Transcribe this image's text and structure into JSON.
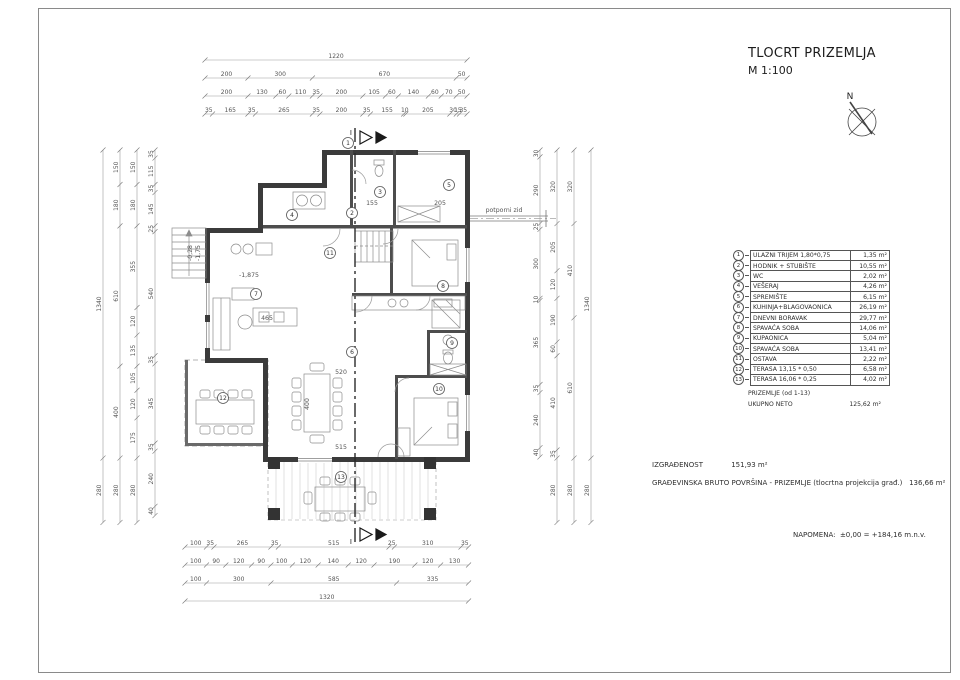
{
  "title_block": {
    "title": "TLOCRT PRIZEMLJA",
    "scale": "M 1:100",
    "north_label": "N"
  },
  "legend": {
    "rows": [
      {
        "num": "1",
        "name": "ULAZNI TRIJEM 1,80*0,75",
        "area": "1,35 m²"
      },
      {
        "num": "2",
        "name": "HODNIK + STUBIŠTE",
        "area": "10,55 m²"
      },
      {
        "num": "3",
        "name": "WC",
        "area": "2,02 m²"
      },
      {
        "num": "4",
        "name": "VEŠERAJ",
        "area": "4,26 m²"
      },
      {
        "num": "5",
        "name": "SPREMIŠTE",
        "area": "6,15 m²"
      },
      {
        "num": "6",
        "name": "KUHINJA+BLAGOVAONICA",
        "area": "26,19 m²"
      },
      {
        "num": "7",
        "name": "DNEVNI BORAVAK",
        "area": "29,77 m²"
      },
      {
        "num": "8",
        "name": "SPAVAĆA SOBA",
        "area": "14,06 m²"
      },
      {
        "num": "9",
        "name": "KUPAONICA",
        "area": "5,04 m²"
      },
      {
        "num": "10",
        "name": "SPAVAĆA SOBA",
        "area": "13,41 m²"
      },
      {
        "num": "11",
        "name": "OSTAVA",
        "area": "2,22 m²"
      },
      {
        "num": "12",
        "name": "TERASA 13,15 * 0,50",
        "area": "6,58 m²"
      },
      {
        "num": "13",
        "name": "TERASA 16,06 * 0,25",
        "area": "4,02 m²"
      }
    ],
    "footer_label": "PRIZEMLJE (od 1-13)",
    "footer_total_label": "UKUPNO NETO",
    "footer_total_area": "125,62 m²"
  },
  "summary": {
    "izgradjenost_label": "IZGRAĐENOST",
    "izgradjenost_value": "151,93 m²",
    "gbp_label": "GRAĐEVINSKA BRUTO POVRŠINA - PRIZEMLJE (tlocrtna projekcija građ.)",
    "gbp_value": "136,66 m²",
    "napomena_label": "NAPOMENA:",
    "napomena_value": "±0,00 = +184,16 m.n.v."
  },
  "plan": {
    "section_label": "I",
    "dim_chains": [
      {
        "dir": "h",
        "x": 205,
        "y": 60,
        "values": [
          1220
        ]
      },
      {
        "dir": "h",
        "x": 205,
        "y": 78,
        "values": [
          200,
          300,
          670,
          50
        ]
      },
      {
        "dir": "h",
        "x": 205,
        "y": 96,
        "values": [
          200,
          130,
          60,
          110,
          35,
          200,
          105,
          60,
          140,
          60,
          70,
          50
        ]
      },
      {
        "dir": "h",
        "x": 205,
        "y": 114,
        "values": [
          35,
          165,
          35,
          265,
          35,
          200,
          35,
          155,
          10,
          205,
          30,
          15,
          35
        ]
      },
      {
        "dir": "h",
        "x": 185,
        "y": 547,
        "values": [
          100,
          35,
          265,
          35,
          515,
          25,
          310,
          35
        ]
      },
      {
        "dir": "h",
        "x": 185,
        "y": 565,
        "values": [
          100,
          90,
          120,
          90,
          100,
          120,
          140,
          120,
          190,
          120,
          130
        ]
      },
      {
        "dir": "h",
        "x": 185,
        "y": 583,
        "values": [
          100,
          300,
          585,
          335
        ]
      },
      {
        "dir": "h",
        "x": 185,
        "y": 601,
        "values": [
          1320
        ]
      },
      {
        "dir": "v",
        "x": 103,
        "y": 150,
        "values": [
          1340,
          280
        ]
      },
      {
        "dir": "v",
        "x": 120,
        "y": 150,
        "values": [
          150,
          180,
          610,
          400,
          280
        ]
      },
      {
        "dir": "v",
        "x": 137,
        "y": 150,
        "values": [
          150,
          180,
          355,
          120,
          135,
          105,
          120,
          175,
          280
        ]
      },
      {
        "dir": "v",
        "x": 155,
        "y": 150,
        "values": [
          35,
          115,
          35,
          145,
          25,
          540,
          35,
          345,
          35,
          240,
          40
        ]
      },
      {
        "dir": "v",
        "x": 540,
        "y": 150,
        "values": [
          30,
          290,
          25,
          300,
          10,
          365,
          35,
          240,
          40
        ]
      },
      {
        "dir": "v",
        "x": 557,
        "y": 150,
        "values": [
          320,
          205,
          120,
          190,
          60,
          410,
          35,
          280
        ]
      },
      {
        "dir": "v",
        "x": 574,
        "y": 150,
        "values": [
          320,
          410,
          610,
          280
        ]
      },
      {
        "dir": "v",
        "x": 591,
        "y": 150,
        "values": [
          1340,
          280
        ]
      }
    ],
    "room_labels": [
      {
        "num": "1",
        "x": 348,
        "y": 143
      },
      {
        "num": "2",
        "x": 352,
        "y": 213
      },
      {
        "num": "3",
        "x": 380,
        "y": 192
      },
      {
        "num": "4",
        "x": 292,
        "y": 215
      },
      {
        "num": "5",
        "x": 449,
        "y": 185
      },
      {
        "num": "6",
        "x": 352,
        "y": 352
      },
      {
        "num": "7",
        "x": 256,
        "y": 294
      },
      {
        "num": "8",
        "x": 443,
        "y": 286
      },
      {
        "num": "9",
        "x": 452,
        "y": 343
      },
      {
        "num": "10",
        "x": 439,
        "y": 389
      },
      {
        "num": "11",
        "x": 330,
        "y": 253
      },
      {
        "num": "12",
        "x": 223,
        "y": 398
      },
      {
        "num": "13",
        "x": 341,
        "y": 477
      }
    ],
    "annotations": [
      {
        "t": "155",
        "x": 372,
        "y": 205
      },
      {
        "t": "205",
        "x": 440,
        "y": 205
      },
      {
        "t": "520",
        "x": 341,
        "y": 374
      },
      {
        "t": "515",
        "x": 341,
        "y": 449
      },
      {
        "t": "465",
        "x": 267,
        "y": 320
      },
      {
        "t": "-1,875",
        "x": 249,
        "y": 277
      },
      {
        "t": "potporni zid",
        "x": 504,
        "y": 212
      },
      {
        "t": "400",
        "x": 309,
        "y": 404,
        "rot": -90
      },
      {
        "t": "-0,28",
        "x": 192,
        "y": 253,
        "rot": -90
      },
      {
        "t": "-1,75",
        "x": 200,
        "y": 253,
        "rot": -90
      }
    ]
  }
}
